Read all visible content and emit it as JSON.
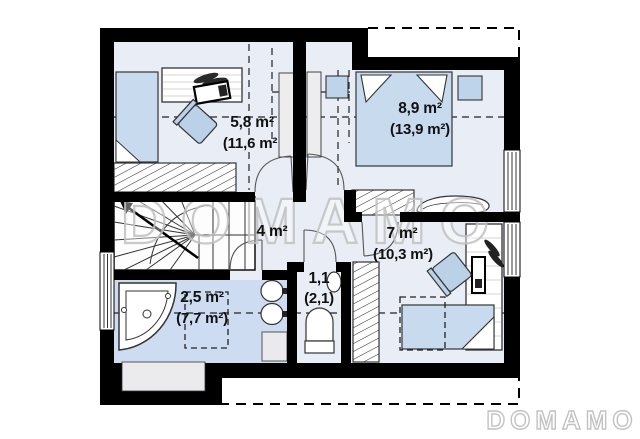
{
  "watermark": "DOMAMO",
  "logo": "DOMAMO",
  "rooms": {
    "office": {
      "area": "5,8 m²",
      "area_gross": "(11,6 m²"
    },
    "bedroom": {
      "area": "8,9 m²",
      "area_gross": "(13,9 m²)"
    },
    "hall": {
      "area": "4 m²"
    },
    "bedroom2": {
      "area": "7 m²",
      "area_gross": "(10,3 m²)"
    },
    "bathroom": {
      "area": "2,5 m²",
      "area_gross": "(7,7 m²)"
    },
    "wc": {
      "area": "1,1",
      "area_gross": "(2,1)"
    }
  },
  "colors": {
    "wall": "#000000",
    "floor": "#e9eef6",
    "bathroom_floor": "#cddcf0",
    "furniture": "#c7daee",
    "watermark": "#bfbfbf"
  }
}
